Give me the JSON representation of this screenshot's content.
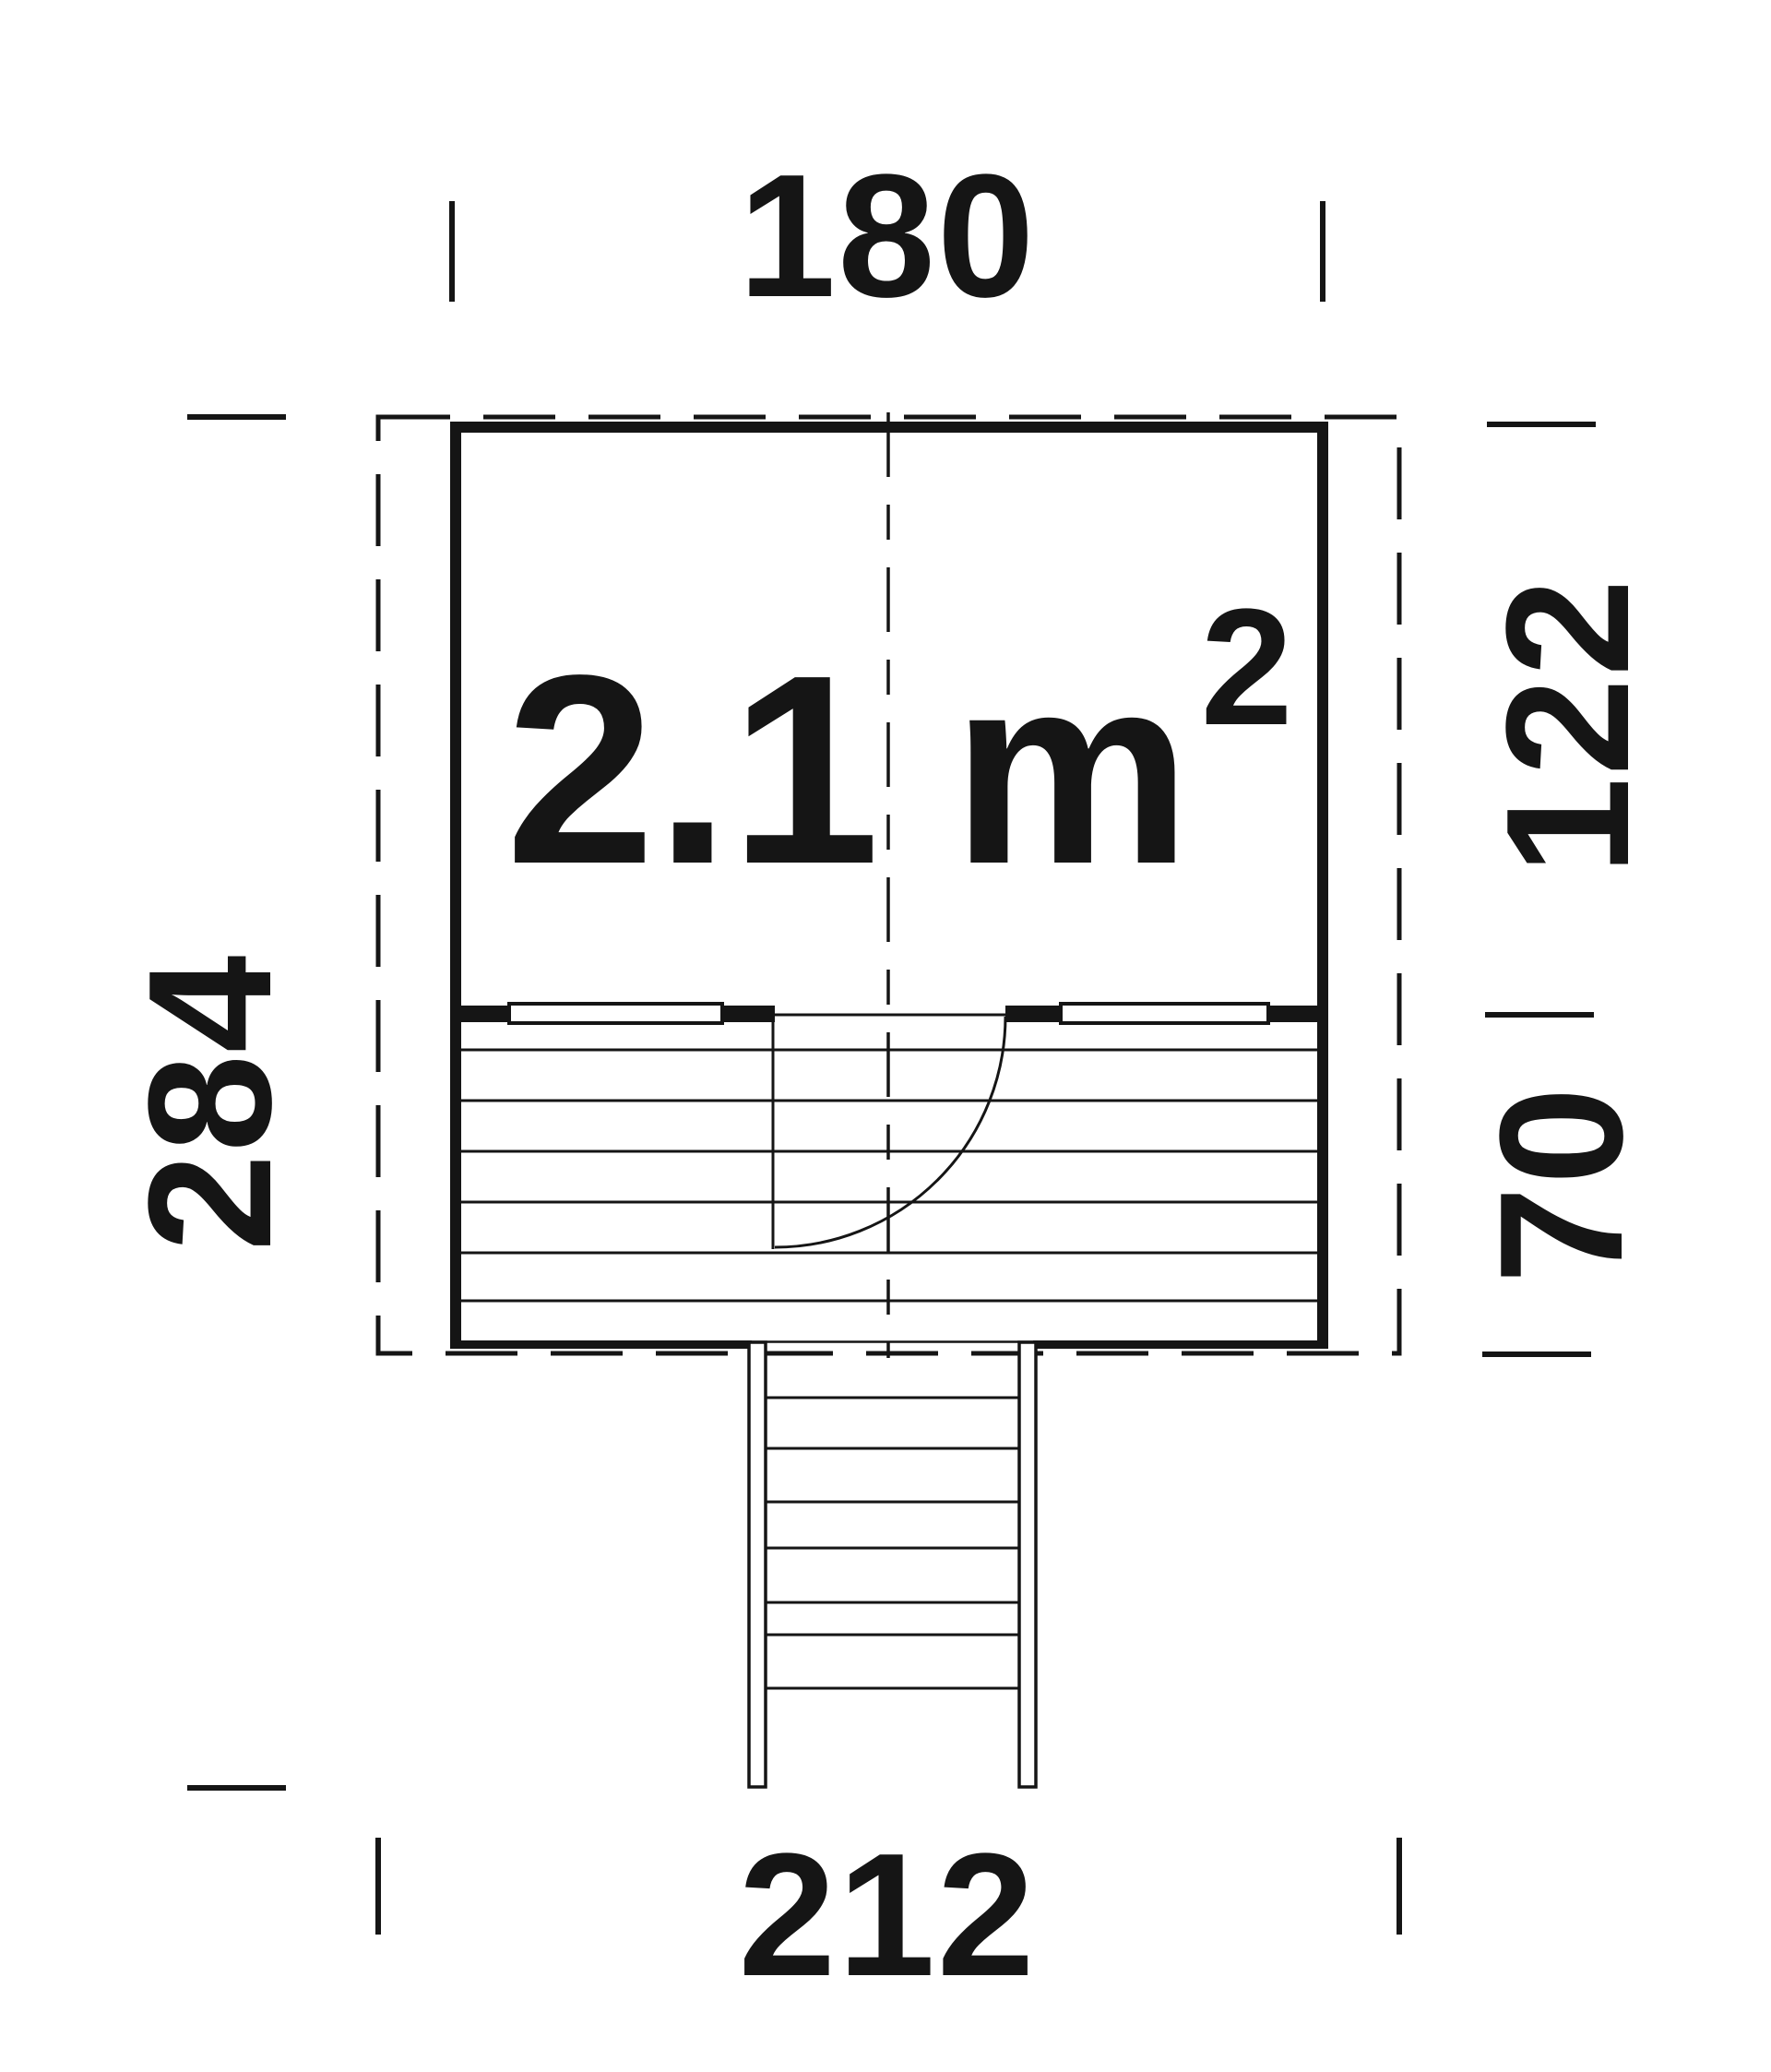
{
  "plan": {
    "title": "playhouse floor plan",
    "area": {
      "value": "2.1",
      "unit_base": "m",
      "unit_exponent": "2"
    },
    "dimensions": {
      "width_top_cm": "180",
      "depth_room_cm": "122",
      "depth_terrace_cm": "70",
      "depth_total_cm": "284",
      "width_bottom_cm": "212"
    },
    "colors": {
      "line": "#151515",
      "background": "#ffffff"
    }
  }
}
